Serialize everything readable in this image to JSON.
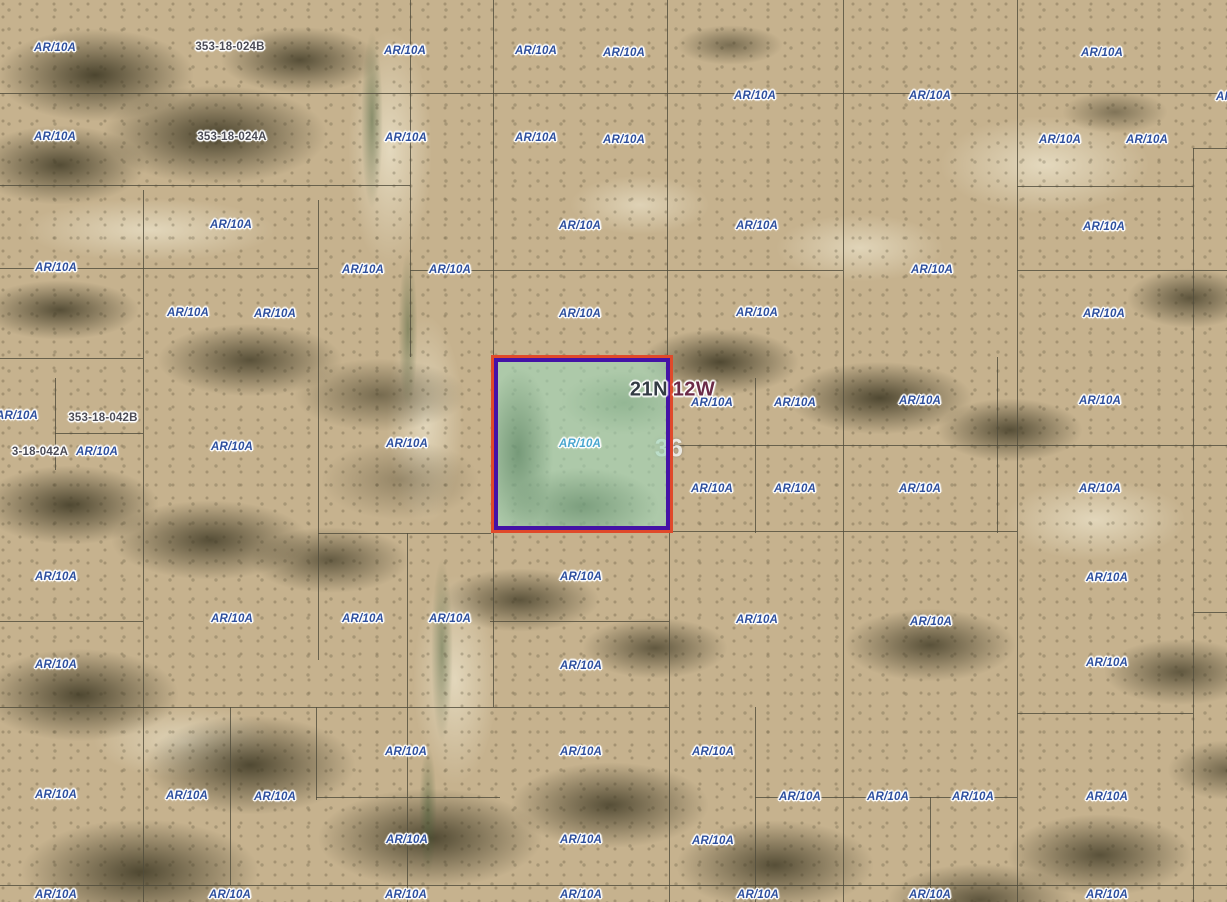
{
  "map": {
    "canvas": {
      "width": 1227,
      "height": 902
    },
    "colors": {
      "zone_label": "#2d4f9e",
      "zone_label_light": "#4aa6cf",
      "parcel_id_label": "#4b4b55",
      "township_n": "#333b44",
      "township_w": "#6b2a47",
      "grid_line": "rgba(80,76,60,0.8)",
      "selected_outer": "#e0492a",
      "selected_inner": "#4412a6",
      "selected_fill": "rgba(158,214,186,0.62)"
    },
    "selected_parcel": {
      "x": 491,
      "y": 355,
      "width": 182,
      "height": 178,
      "label": {
        "text": "AR/10A",
        "x": 580,
        "y": 444
      }
    },
    "township_labels": [
      {
        "text": "21N",
        "x": 649,
        "y": 390,
        "color_key": "township_n"
      },
      {
        "text": "12W",
        "x": 694,
        "y": 390,
        "color_key": "township_w"
      }
    ],
    "section_label": {
      "text": "36",
      "x": 669,
      "y": 449
    },
    "parcel_id_labels": [
      {
        "text": "353-18-024B",
        "x": 230,
        "y": 47
      },
      {
        "text": "353-18-024A",
        "x": 232,
        "y": 137
      },
      {
        "text": "353-18-042B",
        "x": 103,
        "y": 418
      },
      {
        "text": "3-18-042A",
        "x": 40,
        "y": 452
      }
    ],
    "zone_labels": [
      {
        "text": "AR/10A",
        "x": 55,
        "y": 48
      },
      {
        "text": "AR/10A",
        "x": 405,
        "y": 51
      },
      {
        "text": "AR/10A",
        "x": 536,
        "y": 51
      },
      {
        "text": "AR/10A",
        "x": 624,
        "y": 53
      },
      {
        "text": "AR/10A",
        "x": 1102,
        "y": 53
      },
      {
        "text": "AR/10A",
        "x": 755,
        "y": 96
      },
      {
        "text": "AR/10A",
        "x": 930,
        "y": 96
      },
      {
        "text": "AR/10A",
        "x": 1237,
        "y": 97
      },
      {
        "text": "AR/10A",
        "x": 55,
        "y": 137
      },
      {
        "text": "AR/10A",
        "x": 406,
        "y": 138
      },
      {
        "text": "AR/10A",
        "x": 536,
        "y": 138
      },
      {
        "text": "AR/10A",
        "x": 624,
        "y": 140
      },
      {
        "text": "AR/10A",
        "x": 1060,
        "y": 140
      },
      {
        "text": "AR/10A",
        "x": 1147,
        "y": 140
      },
      {
        "text": "AR/10A",
        "x": 231,
        "y": 225
      },
      {
        "text": "AR/10A",
        "x": 580,
        "y": 226
      },
      {
        "text": "AR/10A",
        "x": 757,
        "y": 226
      },
      {
        "text": "AR/10A",
        "x": 1104,
        "y": 227
      },
      {
        "text": "AR/10A",
        "x": 56,
        "y": 268
      },
      {
        "text": "AR/10A",
        "x": 363,
        "y": 270
      },
      {
        "text": "AR/10A",
        "x": 450,
        "y": 270
      },
      {
        "text": "AR/10A",
        "x": 932,
        "y": 270
      },
      {
        "text": "AR/10A",
        "x": 188,
        "y": 313
      },
      {
        "text": "AR/10A",
        "x": 275,
        "y": 314
      },
      {
        "text": "AR/10A",
        "x": 580,
        "y": 314
      },
      {
        "text": "AR/10A",
        "x": 757,
        "y": 313
      },
      {
        "text": "AR/10A",
        "x": 1104,
        "y": 314
      },
      {
        "text": "AR/10A",
        "x": 712,
        "y": 403
      },
      {
        "text": "AR/10A",
        "x": 795,
        "y": 403
      },
      {
        "text": "AR/10A",
        "x": 920,
        "y": 401
      },
      {
        "text": "AR/10A",
        "x": 1100,
        "y": 401
      },
      {
        "text": "AR/10A",
        "x": 17,
        "y": 416
      },
      {
        "text": "AR/10A",
        "x": 97,
        "y": 452
      },
      {
        "text": "AR/10A",
        "x": 232,
        "y": 447
      },
      {
        "text": "AR/10A",
        "x": 407,
        "y": 444
      },
      {
        "text": "AR/10A",
        "x": 712,
        "y": 489
      },
      {
        "text": "AR/10A",
        "x": 795,
        "y": 489
      },
      {
        "text": "AR/10A",
        "x": 920,
        "y": 489
      },
      {
        "text": "AR/10A",
        "x": 1100,
        "y": 489
      },
      {
        "text": "AR/10A",
        "x": 56,
        "y": 577
      },
      {
        "text": "AR/10A",
        "x": 581,
        "y": 577
      },
      {
        "text": "AR/10A",
        "x": 1107,
        "y": 578
      },
      {
        "text": "AR/10A",
        "x": 232,
        "y": 619
      },
      {
        "text": "AR/10A",
        "x": 363,
        "y": 619
      },
      {
        "text": "AR/10A",
        "x": 450,
        "y": 619
      },
      {
        "text": "AR/10A",
        "x": 757,
        "y": 620
      },
      {
        "text": "AR/10A",
        "x": 931,
        "y": 622
      },
      {
        "text": "AR/10A",
        "x": 56,
        "y": 665
      },
      {
        "text": "AR/10A",
        "x": 581,
        "y": 666
      },
      {
        "text": "AR/10A",
        "x": 1107,
        "y": 663
      },
      {
        "text": "AR/10A",
        "x": 406,
        "y": 752
      },
      {
        "text": "AR/10A",
        "x": 581,
        "y": 752
      },
      {
        "text": "AR/10A",
        "x": 713,
        "y": 752
      },
      {
        "text": "AR/10A",
        "x": 56,
        "y": 795
      },
      {
        "text": "AR/10A",
        "x": 187,
        "y": 796
      },
      {
        "text": "AR/10A",
        "x": 275,
        "y": 797
      },
      {
        "text": "AR/10A",
        "x": 800,
        "y": 797
      },
      {
        "text": "AR/10A",
        "x": 888,
        "y": 797
      },
      {
        "text": "AR/10A",
        "x": 973,
        "y": 797
      },
      {
        "text": "AR/10A",
        "x": 1107,
        "y": 797
      },
      {
        "text": "AR/10A",
        "x": 407,
        "y": 840
      },
      {
        "text": "AR/10A",
        "x": 581,
        "y": 840
      },
      {
        "text": "AR/10A",
        "x": 713,
        "y": 841
      },
      {
        "text": "AR/10A",
        "x": 56,
        "y": 895
      },
      {
        "text": "AR/10A",
        "x": 230,
        "y": 895
      },
      {
        "text": "AR/10A",
        "x": 406,
        "y": 895
      },
      {
        "text": "AR/10A",
        "x": 581,
        "y": 895
      },
      {
        "text": "AR/10A",
        "x": 758,
        "y": 895
      },
      {
        "text": "AR/10A",
        "x": 930,
        "y": 895
      },
      {
        "text": "AR/10A",
        "x": 1107,
        "y": 895
      }
    ],
    "parcel_grid": {
      "vertical": [
        {
          "x": 143,
          "y1": 190,
          "y2": 902
        },
        {
          "x": 55,
          "y1": 378,
          "y2": 470
        },
        {
          "x": 230,
          "y1": 707,
          "y2": 885
        },
        {
          "x": 318,
          "y1": 200,
          "y2": 660
        },
        {
          "x": 316,
          "y1": 707,
          "y2": 800
        },
        {
          "x": 410,
          "y1": 0,
          "y2": 357
        },
        {
          "x": 407,
          "y1": 533,
          "y2": 902
        },
        {
          "x": 493,
          "y1": 0,
          "y2": 356
        },
        {
          "x": 493,
          "y1": 533,
          "y2": 707
        },
        {
          "x": 667,
          "y1": 0,
          "y2": 356
        },
        {
          "x": 669,
          "y1": 533,
          "y2": 902
        },
        {
          "x": 755,
          "y1": 378,
          "y2": 533
        },
        {
          "x": 755,
          "y1": 707,
          "y2": 902
        },
        {
          "x": 843,
          "y1": 0,
          "y2": 902
        },
        {
          "x": 930,
          "y1": 797,
          "y2": 902
        },
        {
          "x": 997,
          "y1": 357,
          "y2": 533
        },
        {
          "x": 1017,
          "y1": 0,
          "y2": 902
        },
        {
          "x": 1193,
          "y1": 148,
          "y2": 902
        }
      ],
      "horizontal": [
        {
          "y": 93,
          "x1": 0,
          "x2": 1227
        },
        {
          "y": 148,
          "x1": 1193,
          "x2": 1227
        },
        {
          "y": 185,
          "x1": 0,
          "x2": 410
        },
        {
          "y": 186,
          "x1": 1017,
          "x2": 1193
        },
        {
          "y": 268,
          "x1": 0,
          "x2": 318
        },
        {
          "y": 270,
          "x1": 410,
          "x2": 843
        },
        {
          "y": 270,
          "x1": 1017,
          "x2": 1227
        },
        {
          "y": 358,
          "x1": 0,
          "x2": 143
        },
        {
          "y": 433,
          "x1": 55,
          "x2": 143
        },
        {
          "y": 445,
          "x1": 673,
          "x2": 1227
        },
        {
          "y": 533,
          "x1": 318,
          "x2": 491
        },
        {
          "y": 531,
          "x1": 673,
          "x2": 1017
        },
        {
          "y": 612,
          "x1": 1193,
          "x2": 1227
        },
        {
          "y": 621,
          "x1": 0,
          "x2": 143
        },
        {
          "y": 621,
          "x1": 490,
          "x2": 669
        },
        {
          "y": 707,
          "x1": 0,
          "x2": 669
        },
        {
          "y": 713,
          "x1": 1017,
          "x2": 1193
        },
        {
          "y": 797,
          "x1": 316,
          "x2": 500
        },
        {
          "y": 797,
          "x1": 755,
          "x2": 1017
        },
        {
          "y": 885,
          "x1": 0,
          "x2": 1227
        }
      ]
    }
  }
}
